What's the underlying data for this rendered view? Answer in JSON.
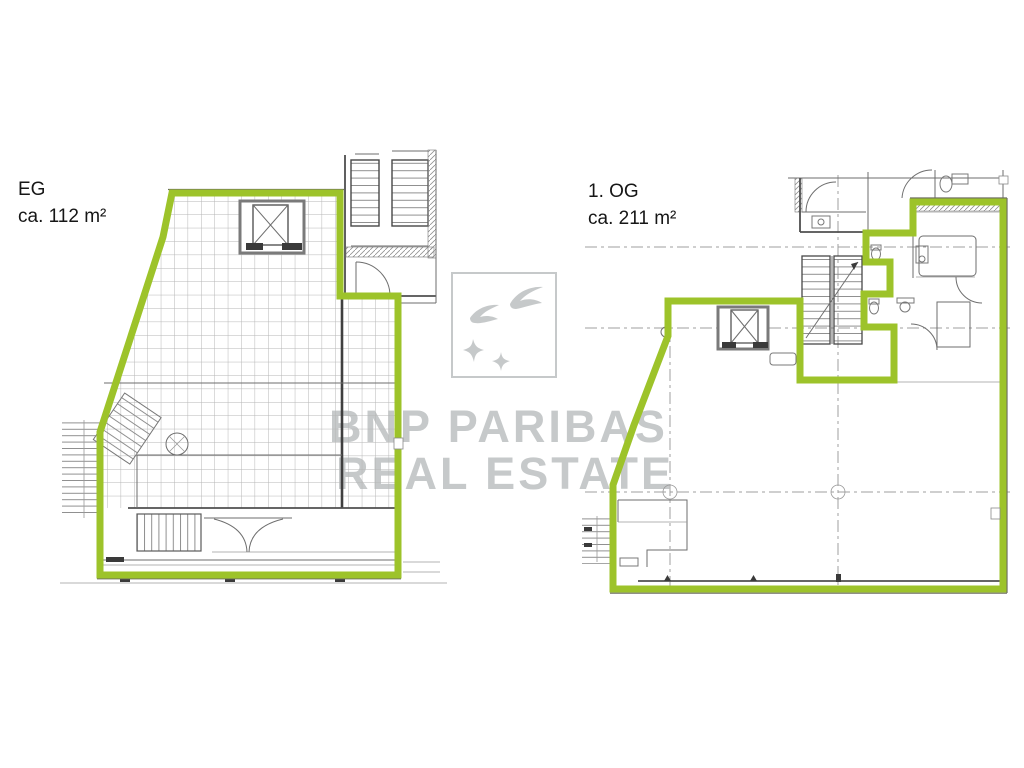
{
  "labels": {
    "eg": {
      "title": "EG",
      "area": "ca. 112 m²"
    },
    "og": {
      "title": "1. OG",
      "area": "ca. 211 m²"
    }
  },
  "watermark": {
    "brand_line1": "BNP PARIBAS",
    "brand_line2": "REAL ESTATE",
    "logo_icon": "bnp-paribas-birds-logo"
  },
  "colors": {
    "outline_green": "#9dc32a",
    "wall_gray": "#555555",
    "grid_gray": "#b6b6b6",
    "watermark_gray": "#c6c9ca",
    "label_black": "#161616"
  }
}
